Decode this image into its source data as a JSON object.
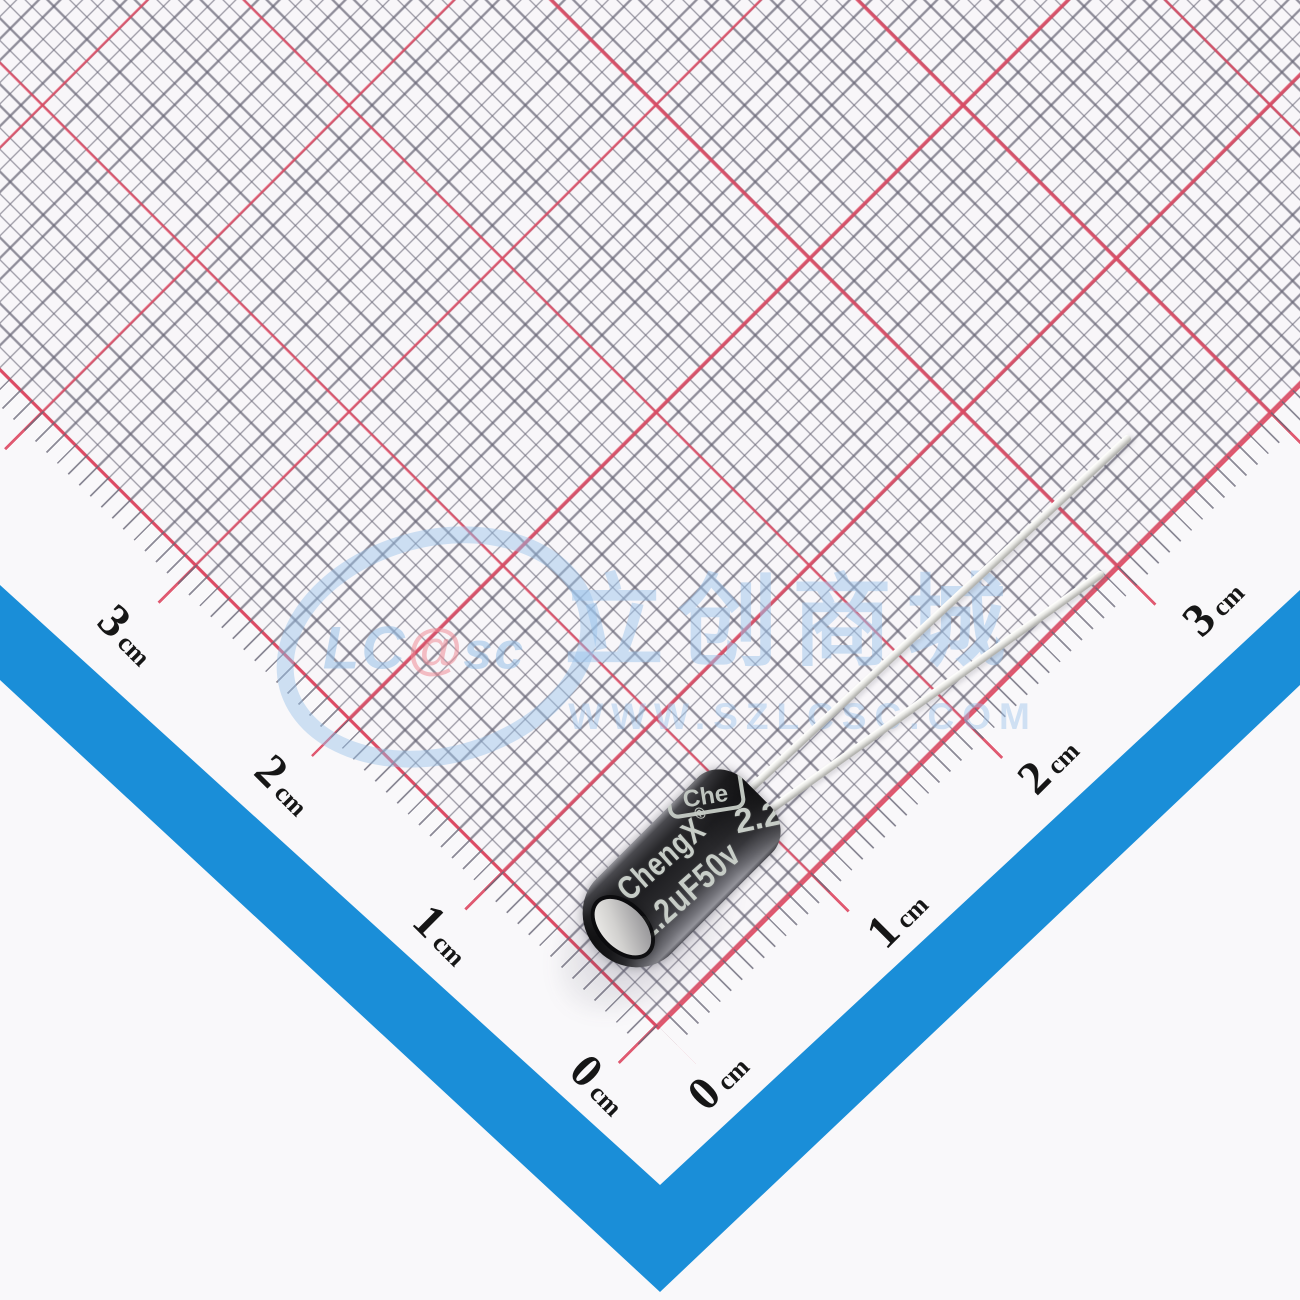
{
  "ruler": {
    "unit": "cm",
    "left": [
      {
        "num": "3",
        "unit": "cm"
      },
      {
        "num": "2",
        "unit": "cm"
      },
      {
        "num": "1",
        "unit": "cm"
      },
      {
        "num": "0",
        "unit": "cm"
      }
    ],
    "right": [
      {
        "num": "0",
        "unit": "cm"
      },
      {
        "num": "1",
        "unit": "cm"
      },
      {
        "num": "2",
        "unit": "cm"
      },
      {
        "num": "3",
        "unit": "cm"
      }
    ]
  },
  "watermark": {
    "logo_l": "LC",
    "logo_at": "@",
    "logo_sc": "sc",
    "brand_cn": "立创商城",
    "website": "WWW.SZLCSC.COM"
  },
  "capacitor": {
    "brand": "ChengX",
    "reg_mark": "®",
    "spec": "2.2uF50v",
    "wrap_spec": "2.2",
    "wrap_brand": "Che"
  },
  "colors": {
    "band_blue": "#1a8ed8",
    "grid_red": "#dd4962",
    "grid_gray": "#686676",
    "paper": "#f8f6f9",
    "watermark_blue": "#9bc3eb",
    "watermark_at_pink": "#ee8c98",
    "cap_print": "#c7cdc7",
    "lead_silver": "#e6e6e2"
  }
}
